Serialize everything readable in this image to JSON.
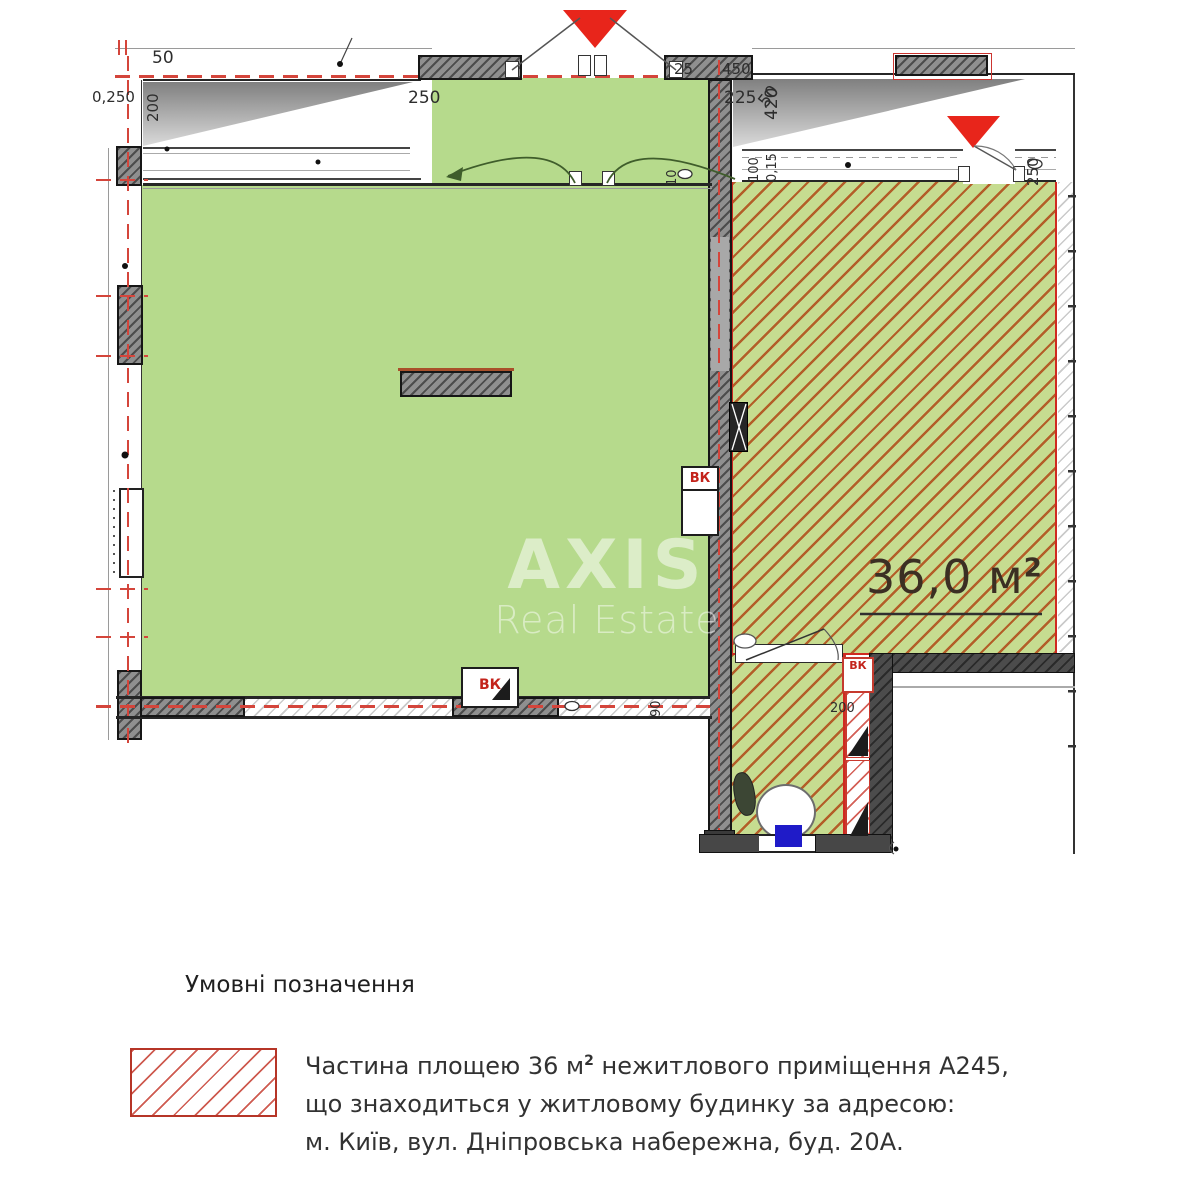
{
  "plan": {
    "watermark": {
      "brand": "AXIS",
      "tagline": "Real Estate"
    },
    "area": {
      "value": "36,0 м",
      "sup": "2"
    },
    "vk": "ВК",
    "dims": [
      {
        "text": "50"
      },
      {
        "text": "0,250"
      },
      {
        "text": "200"
      },
      {
        "text": "250"
      },
      {
        "text": "25"
      },
      {
        "text": "450"
      },
      {
        "text": "50"
      },
      {
        "text": "225"
      },
      {
        "text": "420"
      },
      {
        "text": "100"
      },
      {
        "text": "0,15"
      },
      {
        "text": "250"
      },
      {
        "text": "10"
      },
      {
        "text": "90"
      },
      {
        "text": "200"
      }
    ]
  },
  "legend": {
    "title": "Умовні позначення",
    "line1a": "Частина площею 36 м",
    "line1sup": "2",
    "line1b": " нежитлового приміщення А245,",
    "line2": "що знаходиться у житловому будинку за адресою:",
    "line3": "м. Київ, вул. Дніпровська набережна, буд. 20А."
  },
  "colors": {
    "room_green": "#b6da8c",
    "highlight_fill": "#c6dc90",
    "hatch_line": "#b04816",
    "highlight_border": "#cf2a20",
    "axis_red": "#d4453b",
    "marker_red": "#e8251b",
    "door_blue": "#1f1bc8"
  }
}
